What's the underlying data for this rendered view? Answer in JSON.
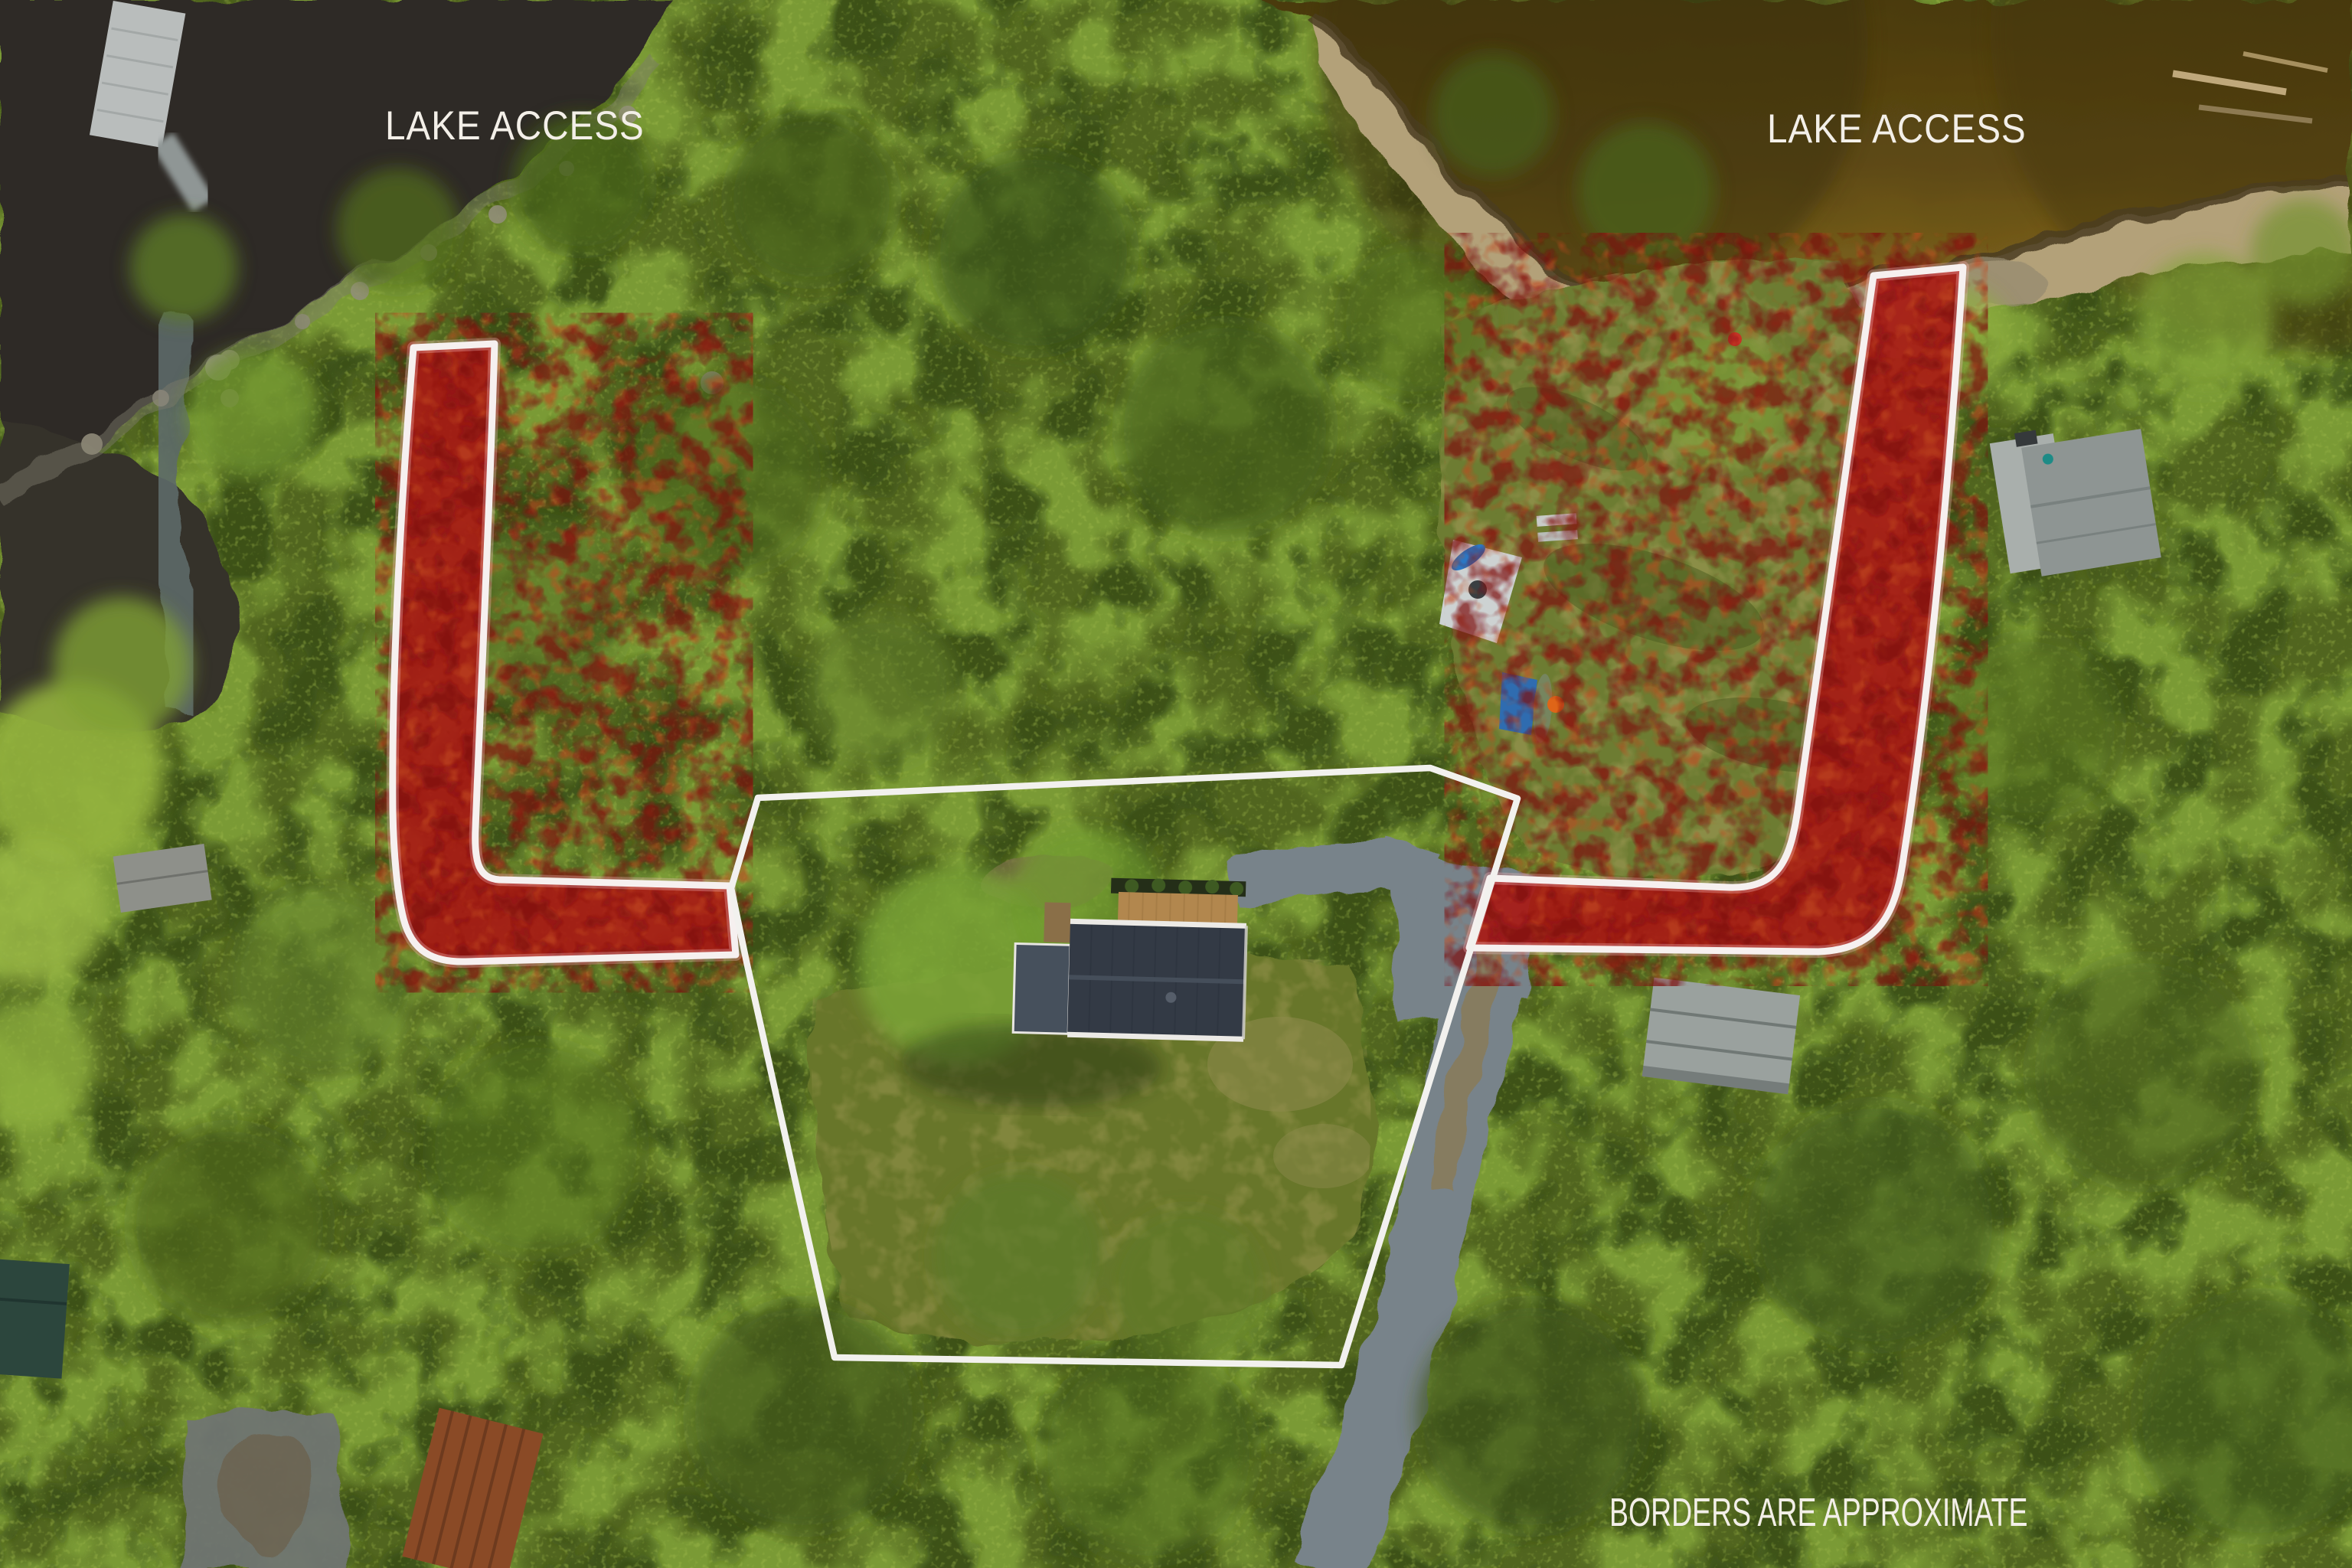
{
  "image_type": "aerial-drone-real-estate-photo",
  "labels": {
    "lake_access_left": "LAKE ACCESS",
    "lake_access_right": "LAKE ACCESS",
    "borders_note": "BORDERS ARE APPROXIMATE"
  },
  "colors": {
    "overlay_red": "#a81a15",
    "overlay_red_dark": "#7d0c10",
    "overlay_red_light": "#c24a20",
    "outline_white": "#f6f0ef",
    "boundary_white": "#f2f1ee",
    "label_text": "#f3efe8",
    "water_dark": "#2d2a26",
    "water_brown_deep": "#4a3a0c",
    "water_brown": "#6a5318",
    "beach_sand": "#b3a179",
    "forest_base": "#51651f",
    "forest_light": "#7fa038",
    "forest_dark": "#3a4f17",
    "lawn_green": "#6d7b31",
    "road_gravel": "#78838a",
    "house_roof": "#333a45",
    "deck_wood": "#b2874e",
    "neighbor_roof": "#8e9593",
    "rust_roof": "#8a4a26"
  },
  "scene_features": [
    "lake-water",
    "sandy-beach-shoreline",
    "rocky-shore",
    "stream",
    "dock",
    "forest-canopy",
    "left-lake-access-corridor",
    "right-lake-access-corridor",
    "property-boundary-polygon",
    "main-house-with-deck",
    "gravel-driveway",
    "gravel-road",
    "neighbor-house",
    "sheds-and-cabins",
    "kayaks-and-bench"
  ]
}
